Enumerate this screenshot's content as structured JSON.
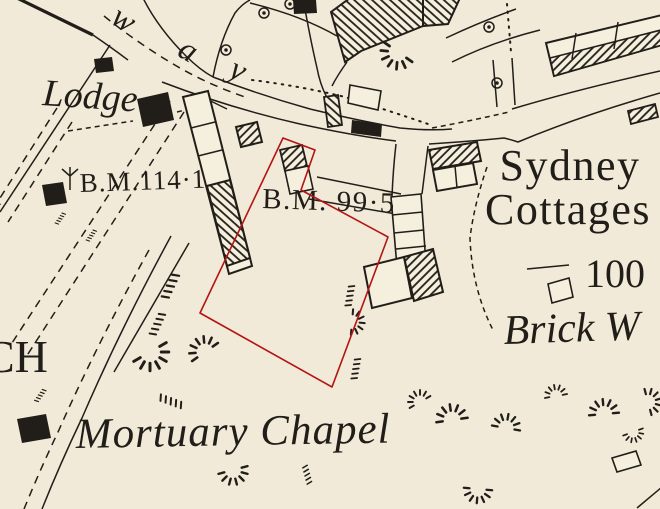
{
  "map": {
    "labels": {
      "way_w": "w",
      "way_a": "a",
      "way_y": "y",
      "lodge": "Lodge",
      "bm_114": "B.M.114·1",
      "bm_99": "B.M. 99·5",
      "sydney_line1": "Sydney",
      "sydney_line2": "Cottages",
      "spot_height": "100",
      "brick_works": "Brick W",
      "mortuary_chapel": "Mortuary Chapel",
      "church_fragment": "CH",
      "left_edge_fragment": "l"
    },
    "colors": {
      "paper": "#f1ead8",
      "ink": "#211e19",
      "overlay_red": "#b41414"
    },
    "overlay": {
      "name": "highlighted-plot-boundary",
      "color": "#b41414",
      "points": "283,138 315,150 301,190 388,237 332,387 200,313"
    }
  }
}
